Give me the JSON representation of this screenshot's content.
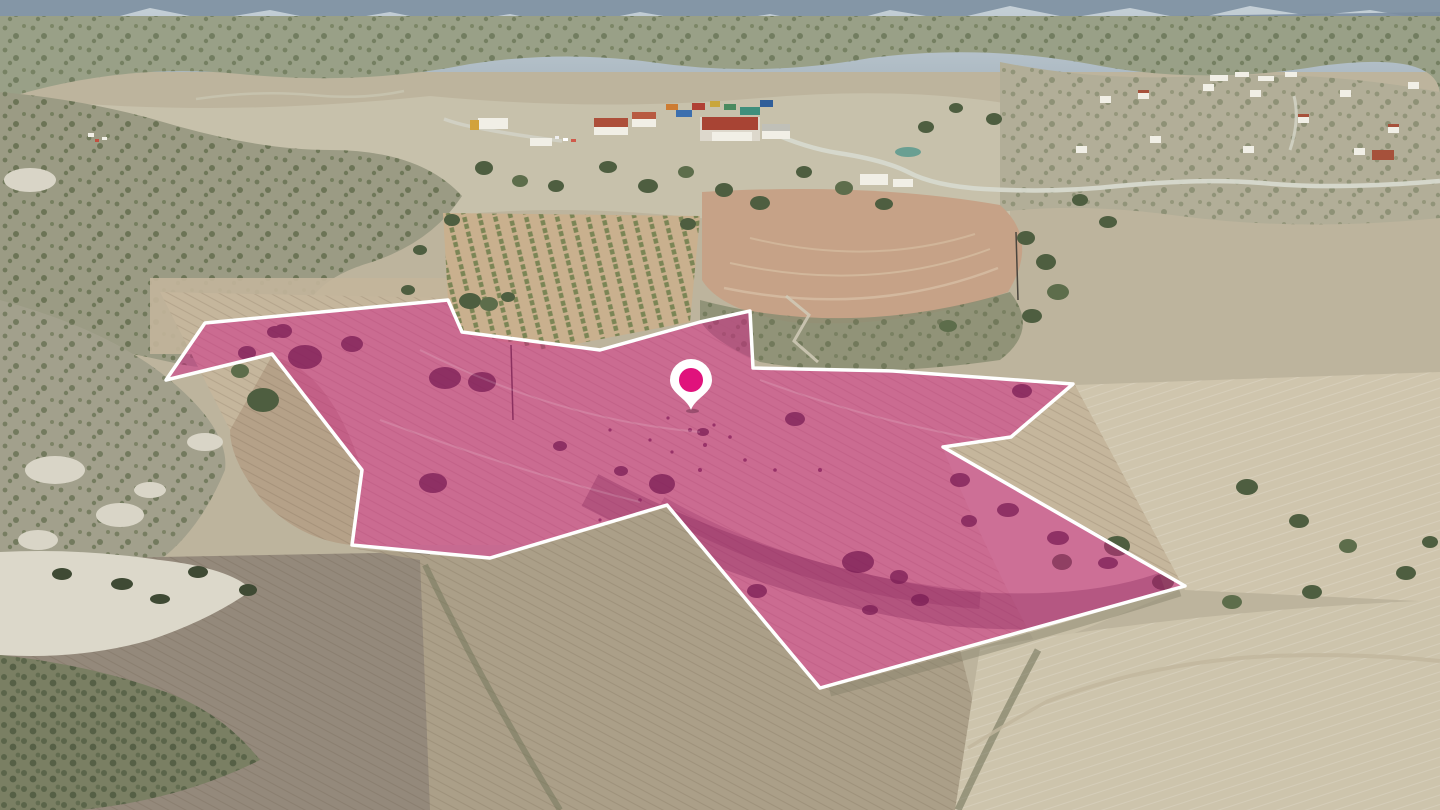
{
  "scene": {
    "kind": "aerial-drone-photograph",
    "description": "Aerial view of a rural valley with scrub hills, ploughed fields, an olive orchard and village buildings; a land parcel is highlighted with a translucent pink overlay, a white boundary line and a location pin."
  },
  "parcel": {
    "points": "166,380 205,323 448,300 462,332 600,350 700,322 750,311 753,368 893,371 1073,384 1011,437 943,447 1185,586 820,688 667,505 490,558 352,545 362,470 272,354",
    "highlight_color": "#d21f86",
    "highlight_opacity": "0.5",
    "outline_color": "#ffffff",
    "outline_width": "3.5"
  },
  "marker": {
    "transform": "translate(691,358)",
    "pin_color": "#ffffff",
    "dot_color": "#e0127c"
  },
  "palette": {
    "sky_haze": "#c6d1d8",
    "far_ridge": "#8496a6",
    "hills_scrub": "#99a087",
    "valley": "#c7c1ab",
    "field_tan": "#c5b69c",
    "field_pale": "#cfc5ad",
    "field_brown": "#c6a287",
    "field_grey": "#94897b",
    "orchard_soil": "#c9b08e",
    "scrub_green": "#55633f",
    "chalk": "#d9d5c7",
    "roof_red": "#a84434",
    "road": "#d7d9cd"
  }
}
